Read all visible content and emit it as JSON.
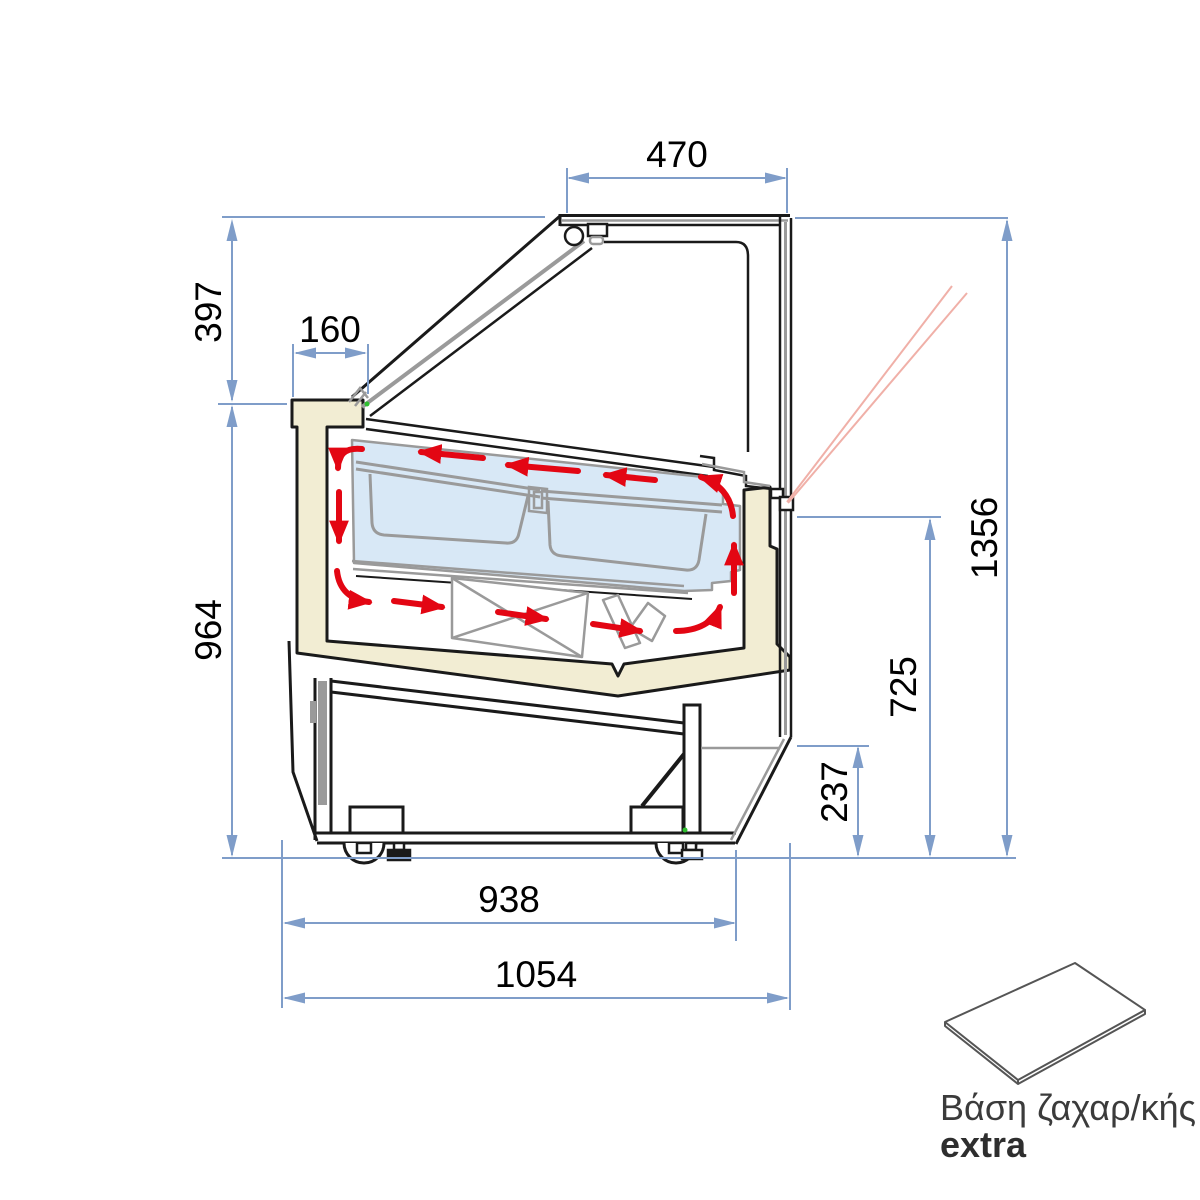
{
  "diagram": {
    "type": "technical-dimension-drawing",
    "subject": "ice-cream display case cross-section with airflow",
    "dims": {
      "top_opening_width": "470",
      "lid_height": "397",
      "back_ledge_width": "160",
      "body_height": "964",
      "total_height": "1356",
      "front_glass_height": "725",
      "base_height": "237",
      "base_width": "938",
      "total_depth": "1054"
    },
    "extra_part": {
      "caption": "Βάση ζαχαρ/κής",
      "tag": "extra"
    },
    "colors": {
      "dimension_blue": "#7f9dc9",
      "airflow_red": "#e30613",
      "insulation_beige": "#f2edd3",
      "glass_blue": "#d8e8f6",
      "metal_gray": "#9a9a9a",
      "outline_black": "#1a1a1a",
      "laser_pink": "#f0b0a8"
    }
  }
}
